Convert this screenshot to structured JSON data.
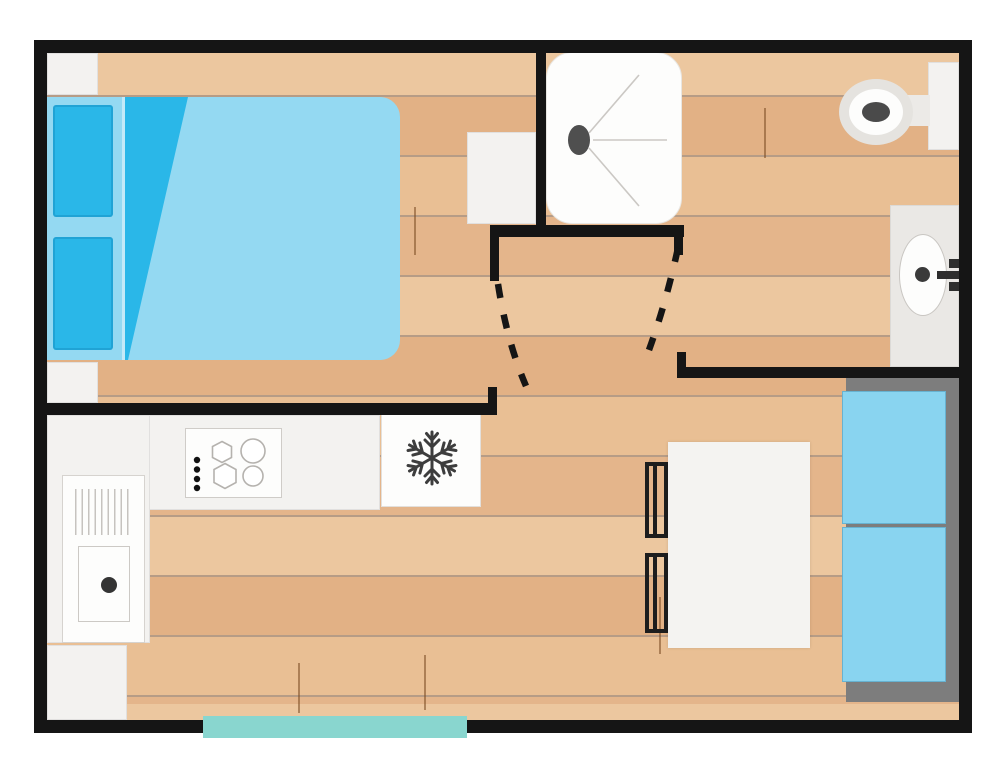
{
  "diagram_type": "mobile-home floor plan (top view)",
  "plan_label": "Studio mobile-home floor plan",
  "rooms": [
    {
      "name": "bedroom",
      "furniture": [
        "double bed with two pillows and folded sheet",
        "corner shelf top-left",
        "corner shelf bottom-left"
      ]
    },
    {
      "name": "shower-room",
      "furniture": [
        "shower tray with drain and spray lines",
        "storage cabinet"
      ]
    },
    {
      "name": "toilet-area",
      "furniture": [
        "toilet with cistern",
        "washbasin counter with oval basin and tap"
      ]
    },
    {
      "name": "kitchen",
      "furniture": [
        "L-shaped worktop",
        "4-burner hob with control knobs",
        "sink with drainer",
        "fridge with snowflake symbol",
        "base cabinet"
      ]
    },
    {
      "name": "living-dining",
      "furniture": [
        "dining table",
        "two chairs",
        "bench seat with two cushions on gray frame"
      ]
    }
  ],
  "doors": [
    {
      "name": "bedroom-door",
      "type": "swing",
      "shown_as": "dashed arc"
    },
    {
      "name": "toilet-door",
      "type": "swing",
      "shown_as": "dashed arc"
    }
  ],
  "entrance": {
    "name": "entrance-step",
    "shown_as": "teal strip on bottom wall"
  },
  "colors": {
    "wall": "#151515",
    "floor-plank-a": "#ecc79f",
    "floor-plank-b": "#e2b185",
    "floor-plank-c": "#e9bf94",
    "floor-plank-d": "#e4b58b",
    "floor-line": "rgba(122,74,34,0.55)",
    "bed-light": "#94d9f2",
    "bed-dark": "#2ab7e8",
    "bench-cushion": "#89d4f0",
    "frame-gray": "#7d7d7d",
    "furniture-white": "#f3f2f0",
    "counter-gray": "#eae8e5",
    "entrance-step": "#89d6cf",
    "detail-dark": "#3f3f3f"
  }
}
